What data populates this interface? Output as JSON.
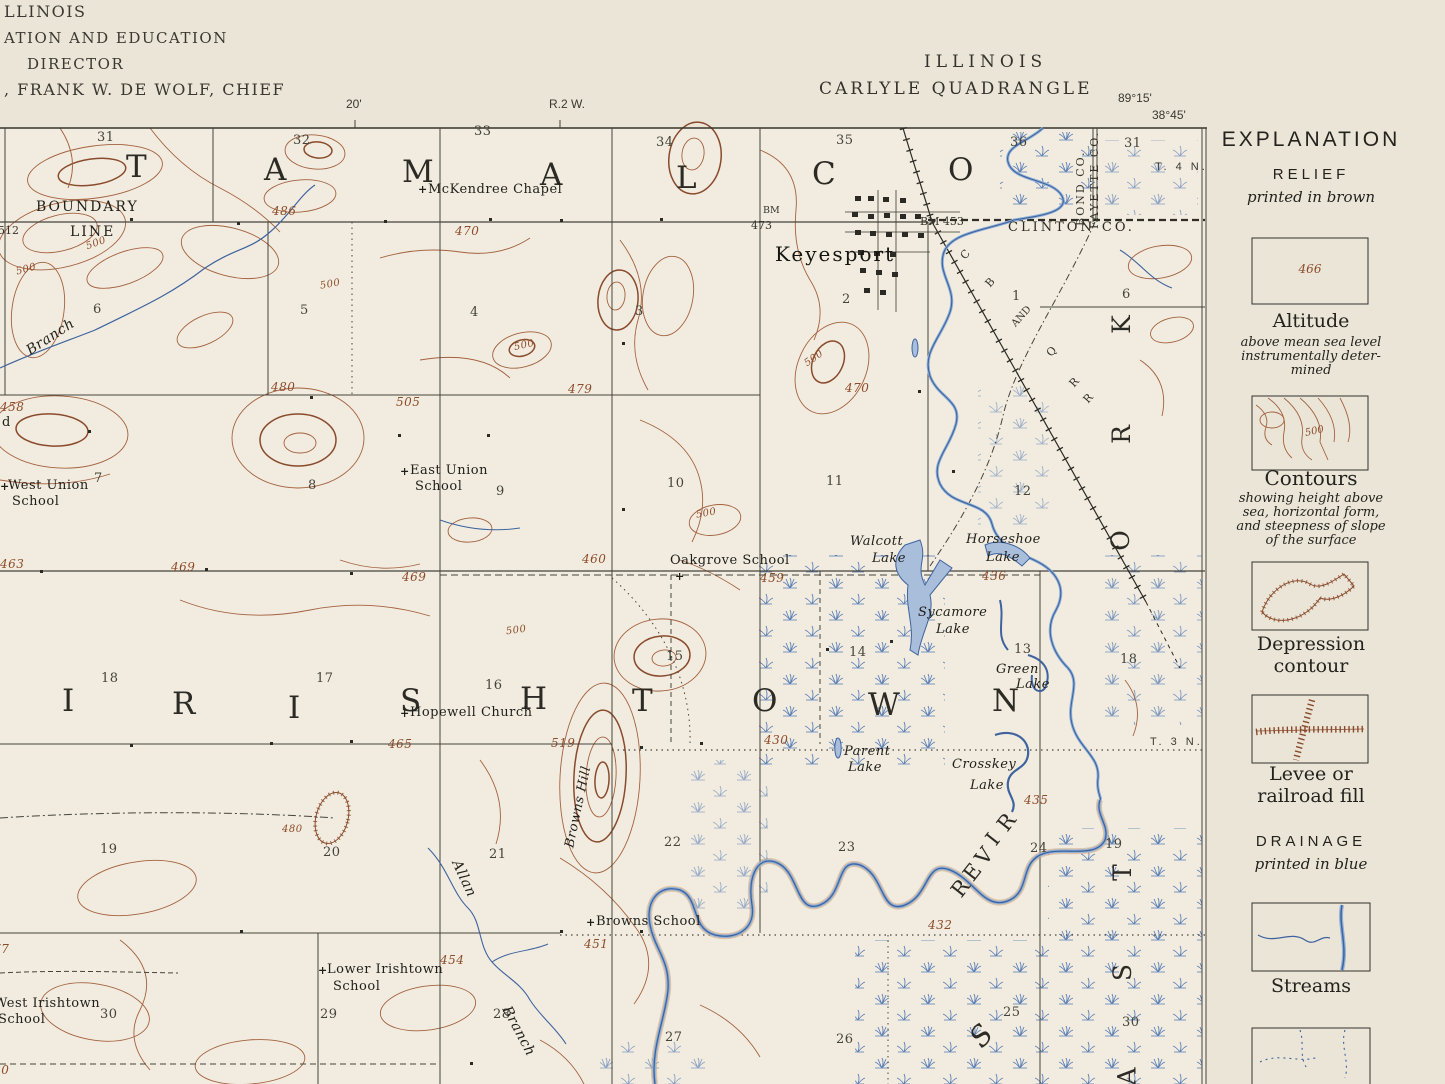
{
  "header": {
    "left_lines": [
      "LLINOIS",
      "ATION AND EDUCATION",
      "DIRECTOR",
      ", FRANK W. DE WOLF, CHIEF"
    ],
    "ruler_minute": "20'",
    "range_label": "R.2 W.",
    "state": "ILLINOIS",
    "quadrangle": "CARLYLE QUADRANGLE",
    "longitude": "89°15'",
    "latitude": "38°45'",
    "township_right_upper": "T. 4 N.",
    "township_right_lower": "T. 3 N."
  },
  "legend": {
    "title": "EXPLANATION",
    "relief_heading": "RELIEF",
    "relief_sub": "printed in brown",
    "altitude_value": "466",
    "altitude_label": "Altitude",
    "altitude_desc1": "above mean sea level",
    "altitude_desc2": "instrumentally deter-",
    "altitude_desc3": "mined",
    "contour_sample_value": "500",
    "contours_label": "Contours",
    "contours_desc1": "showing height above",
    "contours_desc2": "sea, horizontal form,",
    "contours_desc3": "and steepness of slope",
    "contours_desc4": "of the surface",
    "depression_label1": "Depression",
    "depression_label2": "contour",
    "levee_label1": "Levee or",
    "levee_label2": "railroad fill",
    "drainage_heading": "DRAINAGE",
    "drainage_sub": "printed in blue",
    "streams_label": "Streams"
  },
  "map": {
    "glyphs": {
      "cross": "+"
    },
    "townships": {
      "top": [
        "T",
        "A",
        "M",
        "A",
        "L",
        "C",
        "O"
      ],
      "mid": [
        "I",
        "R",
        "I",
        "S",
        "H",
        "T",
        "O",
        "W",
        "N"
      ]
    },
    "river_word": [
      "R",
      "I",
      "V",
      "E",
      "R"
    ],
    "edge_word": [
      "K",
      "R",
      "O",
      "T",
      "S",
      "A"
    ],
    "s_letter": "S",
    "sections": [
      "31",
      "32",
      "33",
      "34",
      "35",
      "36",
      "31",
      "6",
      "5",
      "4",
      "3",
      "2",
      "1",
      "6",
      "7",
      "8",
      "9",
      "10",
      "11",
      "12",
      "18",
      "17",
      "16",
      "15",
      "14",
      "13",
      "18",
      "19",
      "20",
      "21",
      "22",
      "23",
      "24",
      "19",
      "30",
      "29",
      "28",
      "27",
      "26",
      "25",
      "30"
    ],
    "elevations": [
      "486",
      "470",
      "500",
      "500",
      "480",
      "505",
      "479",
      "500",
      "500",
      "458",
      "463",
      "469",
      "469",
      "460",
      "459",
      "436",
      "500",
      "500",
      "500",
      "465",
      "519",
      "480",
      "430",
      "435",
      "477",
      "432",
      "454",
      "451",
      "480",
      "470"
    ],
    "spot_values": {
      "v512": "512",
      "v473": "473"
    },
    "benchmarks": {
      "bm1": "BM",
      "bm2": "BM 453"
    },
    "railroad_letters": [
      "C",
      "B",
      "AND",
      "Q",
      "R",
      "R"
    ],
    "counties": {
      "clinton": "CLINTON CO.",
      "bond": "BOND CO.",
      "fayette": "FAYETTE CO."
    },
    "places": {
      "mckendree": "McKendree Chapel",
      "keyesport": "Keyesport",
      "east_union_1": "East Union",
      "east_union_2": "School",
      "west_union_1": "West Union",
      "west_union_2": "School",
      "oakgrove": "Oakgrove School",
      "hopewell": "Hopewell Church",
      "browns_school": "Browns School",
      "lower_irishtown_1": "Lower Irishtown",
      "lower_irishtown_2": "School",
      "west_irishtown_1": "West Irishtown",
      "west_irishtown_2": "School",
      "walcott_1": "Walcott",
      "walcott_2": "Lake",
      "horseshoe_1": "Horseshoe",
      "horseshoe_2": "Lake",
      "sycamore_1": "Sycamore",
      "sycamore_2": "Lake",
      "green_1": "Green",
      "green_2": "Lake",
      "parent_1": "Parent",
      "parent_2": "Lake",
      "crosskey_1": "Crosskey",
      "crosskey_2": "Lake",
      "boundary_1": "BOUNDARY",
      "boundary_2": "LINE",
      "branch_nw": "Branch",
      "allan": "Allan",
      "allan_branch": "Branch",
      "browns_hill": "Browns Hill",
      "partial_word": "d"
    }
  }
}
